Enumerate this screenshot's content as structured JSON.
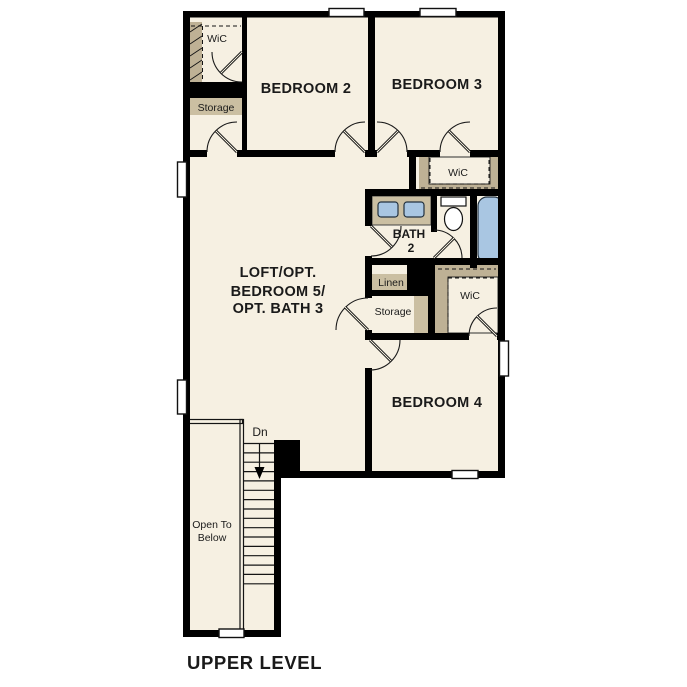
{
  "colors": {
    "background": "#ffffff",
    "room_fill": "#f6f0e2",
    "accent_tan": "#cbbfa2",
    "closet_tan": "#beb195",
    "fixture_blue": "#a9c6e2",
    "wall": "#000000",
    "text_color": "#1a1a1a"
  },
  "plan": {
    "title": "UPPER LEVEL",
    "rooms": {
      "bedroom2": "BEDROOM 2",
      "bedroom3": "BEDROOM 3",
      "bedroom4": "BEDROOM 4",
      "loft_line1": "LOFT/OPT.",
      "loft_line2": "BEDROOM 5/",
      "loft_line3": "OPT. BATH 3",
      "bath_line1": "BATH",
      "bath_line2": "2",
      "wic_bedroom2": "WiC",
      "wic_bedroom3": "WiC",
      "wic_bedroom4": "WiC",
      "storage_upper": "Storage",
      "storage_hall": "Storage",
      "linen": "Linen",
      "stairs_dn": "Dn",
      "open_below_line1": "Open To",
      "open_below_line2": "Below"
    }
  }
}
